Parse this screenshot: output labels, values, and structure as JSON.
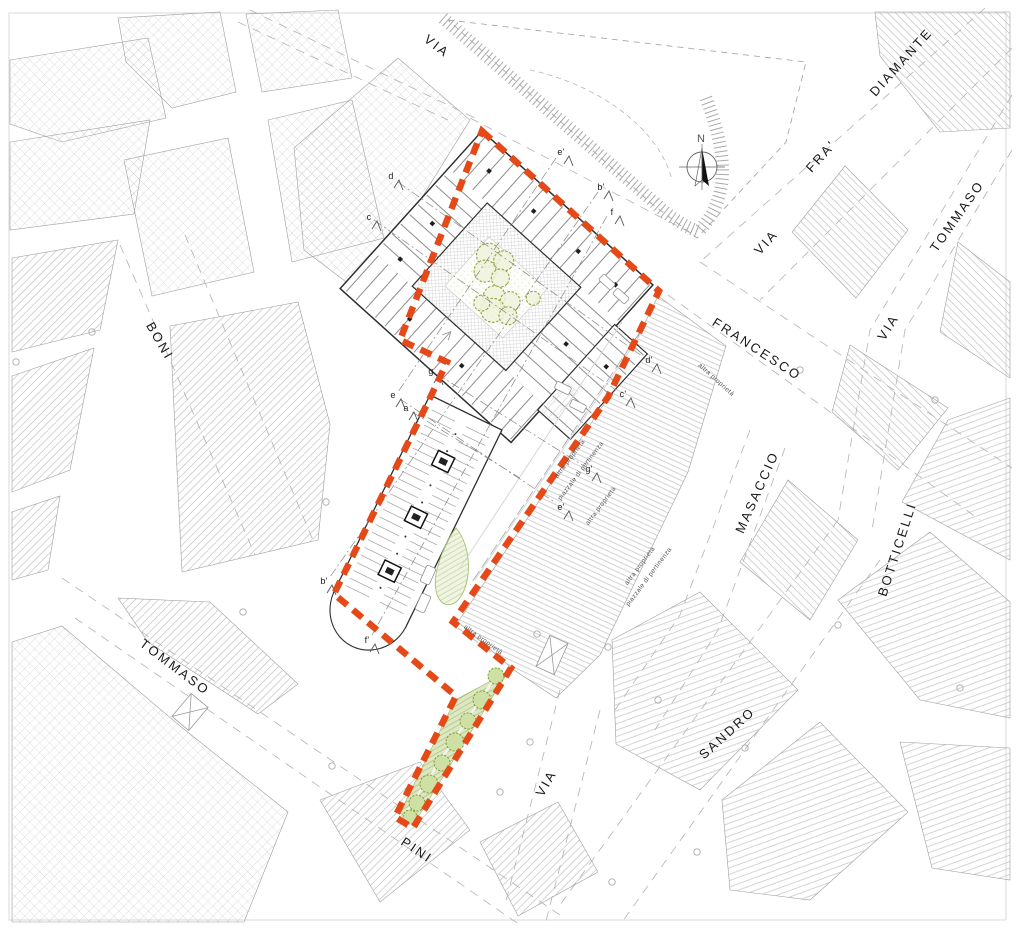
{
  "compass": {
    "label": "N"
  },
  "colors": {
    "boundary": "#E54917",
    "tree_stroke": "#8CA63C",
    "green_fill": "#DDE7C2",
    "hatch": "#B8B8B8"
  },
  "street_labels": [
    {
      "id": "via-top",
      "label": "VIA",
      "x": 437,
      "y": 46,
      "rot": 38
    },
    {
      "id": "diamante",
      "label": "DIAMANTE",
      "x": 901,
      "y": 62,
      "rot": -48
    },
    {
      "id": "fra",
      "label": "FRA'",
      "x": 821,
      "y": 156,
      "rot": -48
    },
    {
      "id": "via-fra",
      "label": "VIA",
      "x": 766,
      "y": 242,
      "rot": -48
    },
    {
      "id": "tommaso-ne",
      "label": "TOMMASO",
      "x": 957,
      "y": 216,
      "rot": -55
    },
    {
      "id": "via-e",
      "label": "VIA",
      "x": 888,
      "y": 327,
      "rot": -58
    },
    {
      "id": "francesco",
      "label": "FRANCESCO",
      "x": 757,
      "y": 349,
      "rot": 33
    },
    {
      "id": "boni",
      "label": "BONI",
      "x": 160,
      "y": 341,
      "rot": 60
    },
    {
      "id": "masaccio",
      "label": "MASACCIO",
      "x": 757,
      "y": 492,
      "rot": -66
    },
    {
      "id": "botticelli",
      "label": "BOTTICELLI",
      "x": 897,
      "y": 549,
      "rot": -72
    },
    {
      "id": "tommaso-sw",
      "label": "TOMMASO",
      "x": 175,
      "y": 667,
      "rot": 37
    },
    {
      "id": "sandro",
      "label": "SANDRO",
      "x": 727,
      "y": 733,
      "rot": -42
    },
    {
      "id": "via-s",
      "label": "VIA",
      "x": 546,
      "y": 783,
      "rot": -60
    },
    {
      "id": "pini",
      "label": "PINI",
      "x": 417,
      "y": 850,
      "rot": 34
    }
  ],
  "annotations": [
    {
      "id": "altra-1",
      "label": "altra proprietà",
      "x": 570,
      "y": 459,
      "rot": -53
    },
    {
      "id": "piazzale-1",
      "label": "piazzale di pertinenza",
      "x": 581,
      "y": 471,
      "rot": -53
    },
    {
      "id": "altra-2",
      "label": "altra proprietà",
      "x": 601,
      "y": 506,
      "rot": -53
    },
    {
      "id": "altra-3",
      "label": "altra proprietà",
      "x": 716,
      "y": 380,
      "rot": 42
    },
    {
      "id": "altra-4",
      "label": "altra proprietà",
      "x": 483,
      "y": 640,
      "rot": 36
    },
    {
      "id": "altra-5",
      "label": "altra proprietà",
      "x": 640,
      "y": 566,
      "rot": -53
    },
    {
      "id": "piazzale-2",
      "label": "piazzale di pertinenza",
      "x": 649,
      "y": 577,
      "rot": -53
    }
  ],
  "section_markers": [
    {
      "label": "d",
      "x": 391,
      "y": 176
    },
    {
      "label": "c",
      "x": 369,
      "y": 217
    },
    {
      "label": "e'",
      "x": 561,
      "y": 152
    },
    {
      "label": "b'",
      "x": 601,
      "y": 187
    },
    {
      "label": "f",
      "x": 612,
      "y": 212
    },
    {
      "label": "d'",
      "x": 649,
      "y": 360
    },
    {
      "label": "c'",
      "x": 623,
      "y": 394
    },
    {
      "label": "g'",
      "x": 589,
      "y": 469
    },
    {
      "label": "e'",
      "x": 561,
      "y": 507
    },
    {
      "label": "g",
      "x": 431,
      "y": 371
    },
    {
      "label": "e",
      "x": 393,
      "y": 395
    },
    {
      "label": "a",
      "x": 406,
      "y": 408
    },
    {
      "label": "b'",
      "x": 324,
      "y": 581
    },
    {
      "label": "f'",
      "x": 367,
      "y": 640
    }
  ]
}
